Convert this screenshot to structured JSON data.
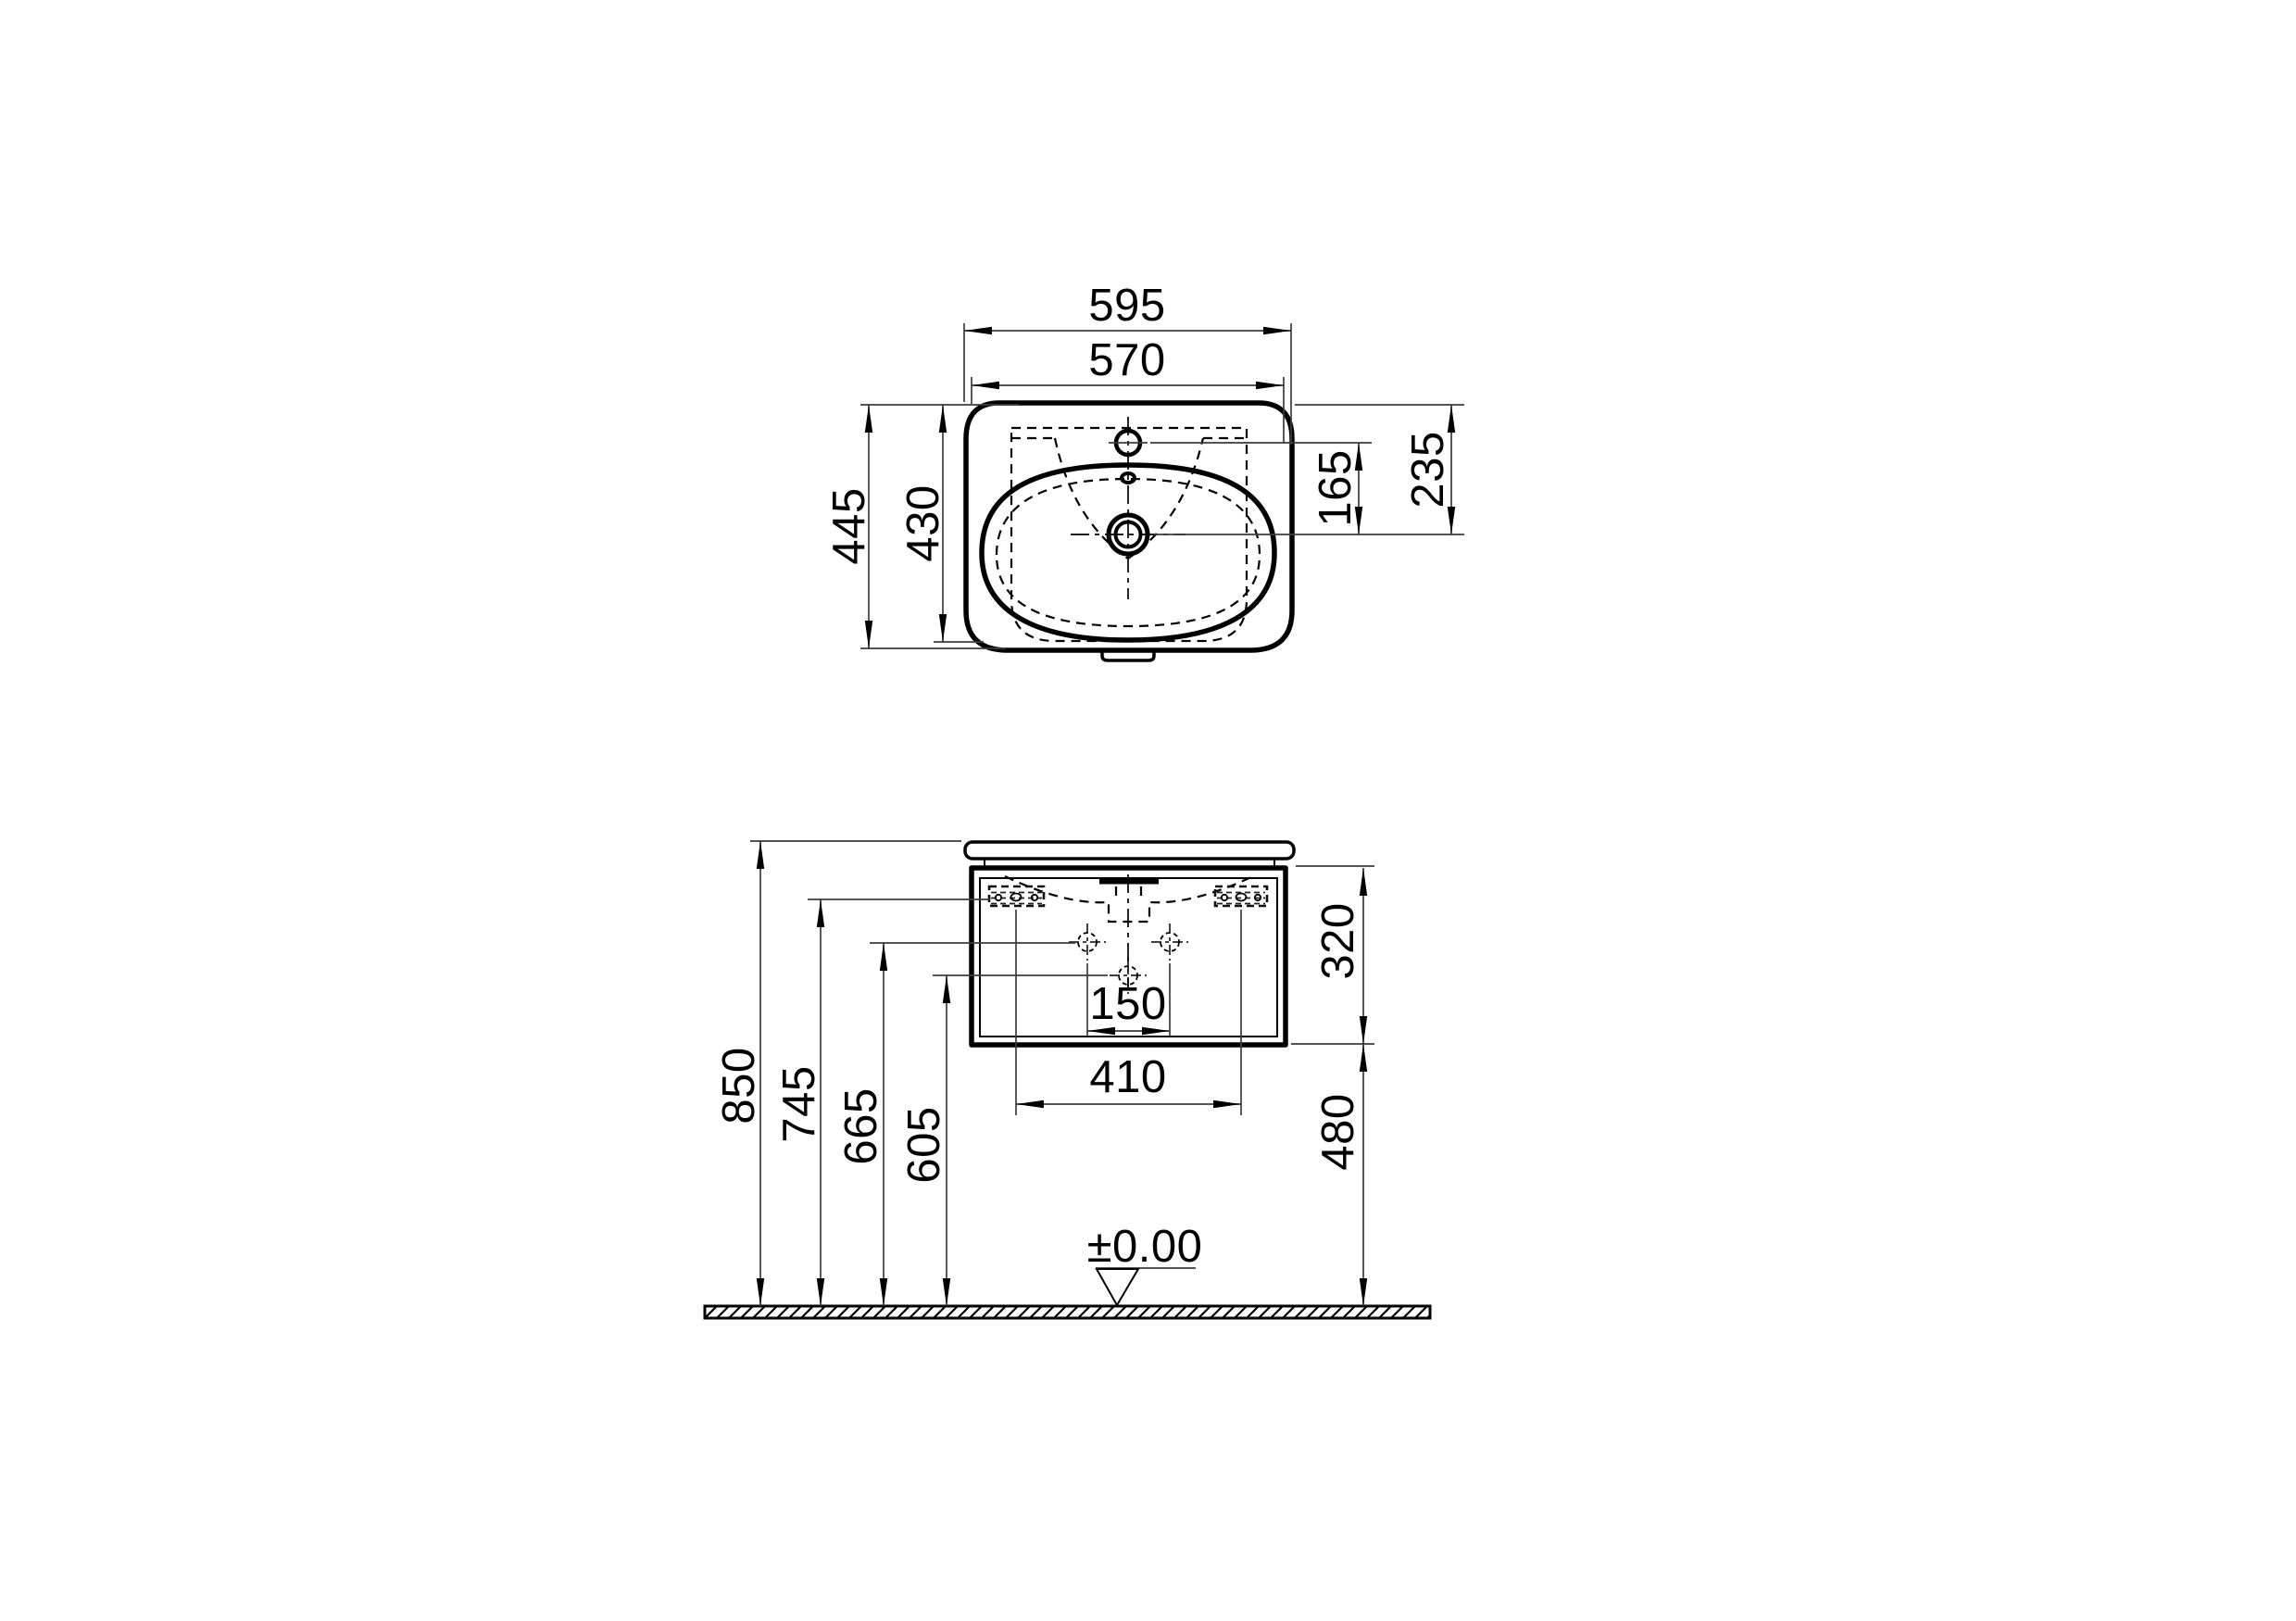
{
  "plan_view": {
    "dims": {
      "overall_width": "595",
      "inner_width": "570",
      "overall_depth": "445",
      "inner_depth": "430",
      "tap_to_drain": "165",
      "rear_to_drain": "235"
    }
  },
  "front_view": {
    "dims": {
      "rim_height": "850",
      "bracket_height": "745",
      "upper_fixing_height": "665",
      "siphon_height": "605",
      "fixing_spacing": "150",
      "bracket_spacing": "410",
      "cabinet_height": "320",
      "floor_clearance": "480"
    },
    "datum_label": "±0.00"
  },
  "colors": {
    "background": "#ffffff",
    "line": "#000000",
    "dim_line": "#3c3c3c"
  }
}
